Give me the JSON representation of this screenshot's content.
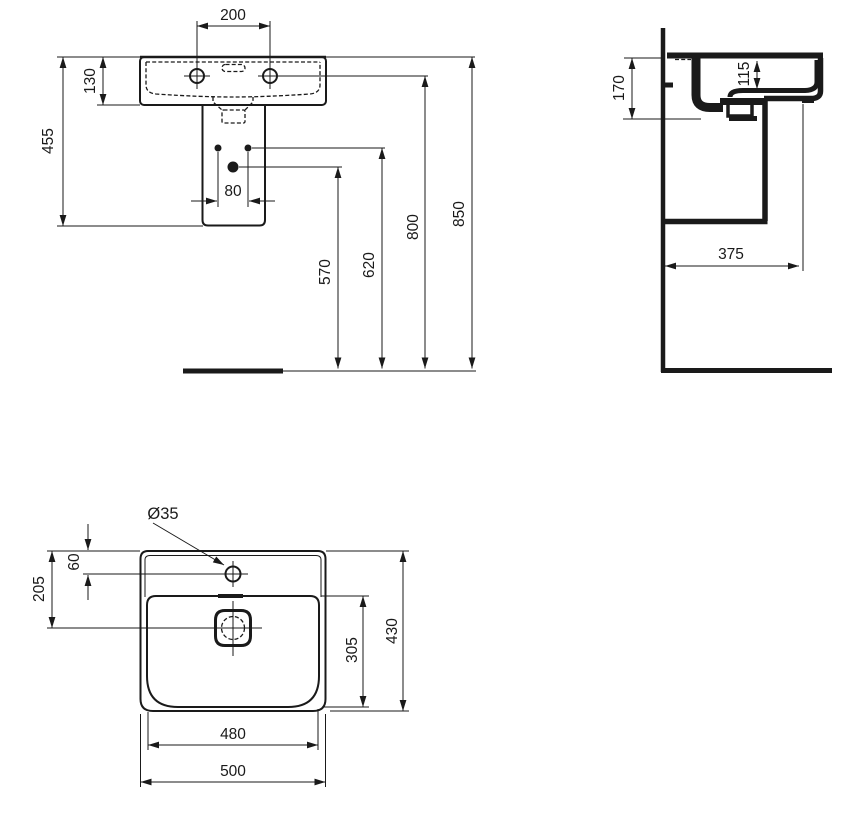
{
  "drawing": {
    "type": "washbasin technical drawing",
    "colors": {
      "ink": "#1a1a1a",
      "background": "#ffffff"
    }
  },
  "views": {
    "front": {
      "dims": {
        "tap_spacing": "200",
        "rim_to_underside": "130",
        "rim_to_pedestal_bottom": "455",
        "fixing_holes_spacing": "80",
        "waste_outlet_height": "570",
        "fixing_holes_height": "620",
        "tap_holes_height": "800",
        "rim_height": "850"
      }
    },
    "side": {
      "dims": {
        "front_height": "170",
        "bowl_depth": "115",
        "projection": "375"
      }
    },
    "plan": {
      "dims": {
        "tap_hole_diameter": "Ø35",
        "rim_to_tap_center": "60",
        "rim_to_drain_center": "205",
        "bowl_length": "305",
        "overall_depth": "430",
        "bowl_width": "480",
        "overall_width": "500"
      }
    }
  }
}
